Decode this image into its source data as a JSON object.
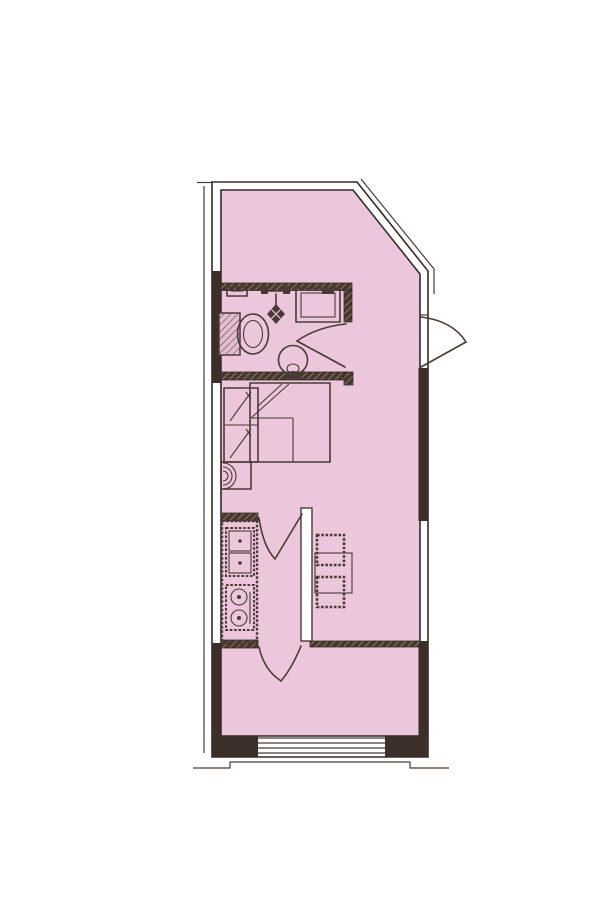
{
  "document": {
    "type": "apartment-floor-plan-drawing",
    "description": "Scanned one-room studio apartment floor plan, pink floor fill, no text labels",
    "text_labels": []
  },
  "palette": {
    "background": "#ffffff",
    "floor_fill": "#ecc7dc",
    "wall_dark": "#3c2f2a",
    "line": "#4a3a36",
    "edge": "#342c28",
    "hatch_dark": "#46382f",
    "hatch_light": "#97816f"
  },
  "floorplan": {
    "shape": "tall rectangle with chamfered (diagonal) top-right corner",
    "entry": {
      "side": "right",
      "door_swing": "outward",
      "position": "upper right below chamfer"
    },
    "rooms": [
      {
        "name": "bathroom",
        "location": "upper left band",
        "fixtures": [
          "wall-shelf",
          "shower-head",
          "washing-machine",
          "toilet",
          "pedestal-sink"
        ],
        "door": "inward swinging door at right end of bathroom"
      },
      {
        "name": "sleeping-area",
        "location": "middle band",
        "fixtures": [
          "wardrobe-two-section",
          "double-bed-with-folded-blanket",
          "small-appliance-with-arcs"
        ],
        "window": "left wall window"
      },
      {
        "name": "kitchen-dining",
        "location": "lower middle band",
        "fixtures": [
          "counter-run",
          "double-bowl-sink",
          "two-burner-stove",
          "dining-table",
          "stool",
          "stool"
        ],
        "door": "door between hallway and kitchen",
        "window": "right wall window"
      },
      {
        "name": "balcony",
        "location": "bottom band",
        "door": "door from kitchen down into balcony",
        "window": "wide sliding window in bottom exterior wall"
      }
    ],
    "wall_legend": {
      "black_fill": "solid structural wall",
      "double_white_line": "window / light wall",
      "hatched_band": "interior partition wall"
    }
  }
}
